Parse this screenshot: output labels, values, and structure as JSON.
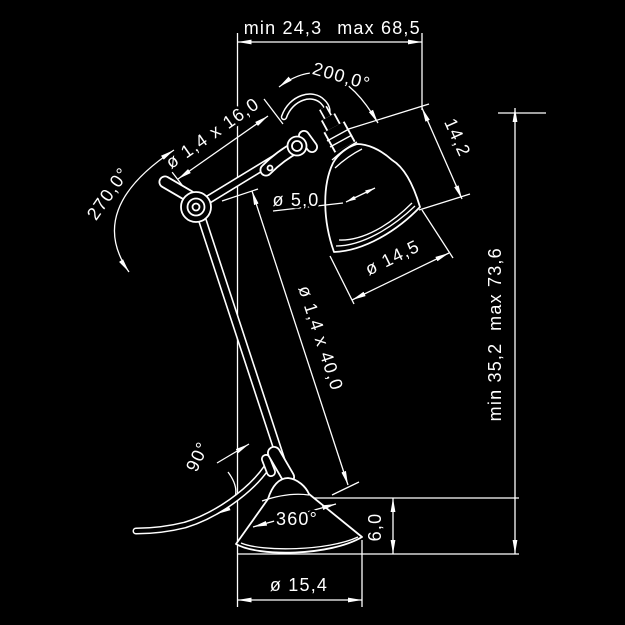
{
  "drawing": {
    "background": "#000000",
    "line_color": "#ffffff",
    "subject": "articulated desk lamp dimensional drawing",
    "labels": {
      "width_min": "min 24,3",
      "width_max": "max 68,5",
      "height_min": "min 35,2",
      "height_max": "max 73,6",
      "head_swivel_angle": "200,0°",
      "elbow_swivel_angle": "270,0°",
      "upper_arm_tube": "ø 1,4 x 16,0",
      "lower_arm_tube": "ø 1,4 x 40,0",
      "socket_diameter": "ø 5,0",
      "shade_depth": "14,2",
      "shade_diameter": "ø 14,5",
      "base_joint_angle": "90°",
      "base_swivel_angle": "360°",
      "base_height": "6,0",
      "base_diameter": "ø 15,4"
    }
  }
}
